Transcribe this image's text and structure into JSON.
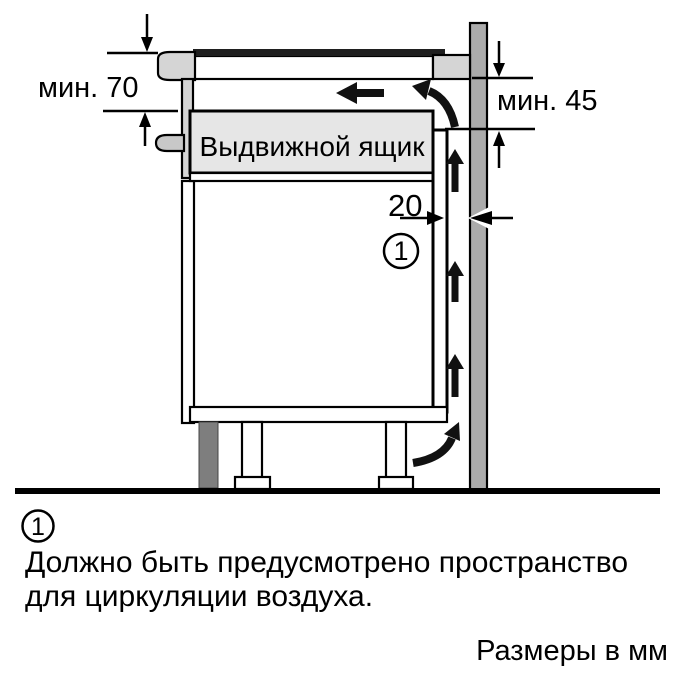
{
  "diagram": {
    "labels": {
      "min_top_left": "мин. 70",
      "min_right": "мин. 45",
      "gap": "20",
      "drawer": "Выдвижной ящик",
      "callout": "1"
    },
    "colors": {
      "wall": "#ababab",
      "panel_light": "#d5d5d5",
      "drawer_fill": "#e6e6e6",
      "handle": "#c8c8c8",
      "plinth": "#7e7e7e",
      "hob_surface": "#1f1f1f",
      "white": "#ffffff"
    }
  },
  "footnote": {
    "marker": "1",
    "line1": "Должно быть предусмотрено пространство",
    "line2": "для циркуляции воздуха."
  },
  "units_note": "Размеры в мм"
}
